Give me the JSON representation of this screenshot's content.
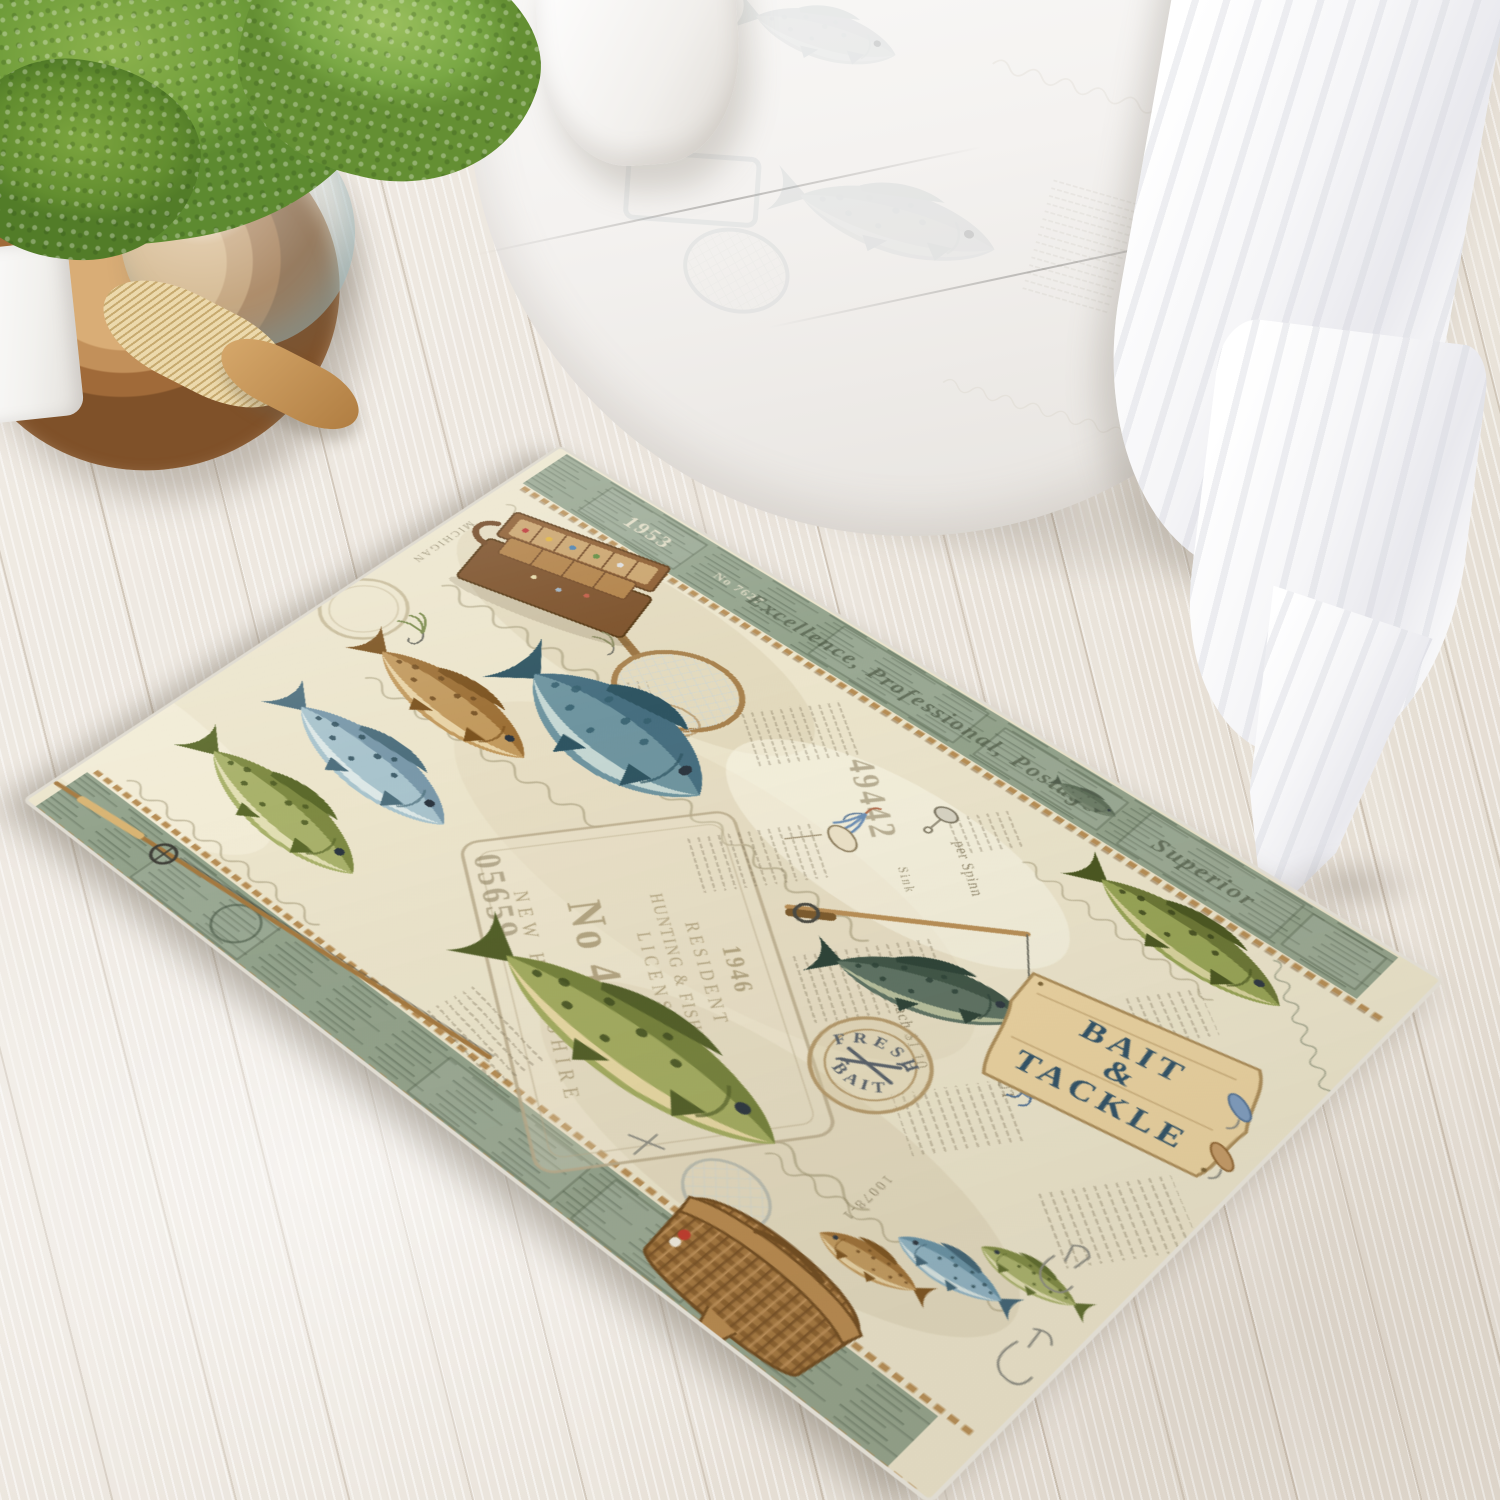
{
  "rug": {
    "sign": {
      "line1": "BAIT",
      "amp": "&",
      "line2": "TACKLE"
    },
    "stamp": {
      "top": "FRESH",
      "bottom": "BAIT"
    },
    "license": {
      "year": "1946",
      "line1": "RESIDENT",
      "line2": "HUNTING & FISHING",
      "line3": "LICENSE",
      "number": "No 46981",
      "state": "NEW HAMPSHIRE"
    },
    "serials": {
      "a": "49442",
      "b": "05659",
      "band_year": "1953",
      "band_no": "No 7627",
      "lot": "10078-1"
    },
    "script_band": "Excellence, Professional, Postage",
    "script_superior": "Superior",
    "price": "Each $1.10",
    "script_spinn": "per Spinn",
    "script_sink": "Sink",
    "rout_text": "ROUT",
    "margin_text": "MICHIGAN"
  },
  "palette": {
    "rug_cream": "#ece5cc",
    "band_green": "#93a38c",
    "rope_trim": "#b78e55",
    "sign_navy": "#2e5066",
    "stamp_tan": "#b59a6c",
    "floor": "#ece6de",
    "tub_white": "#fafaf9",
    "plant_green": "#7aa845",
    "tray_wood": "#c2905a"
  }
}
